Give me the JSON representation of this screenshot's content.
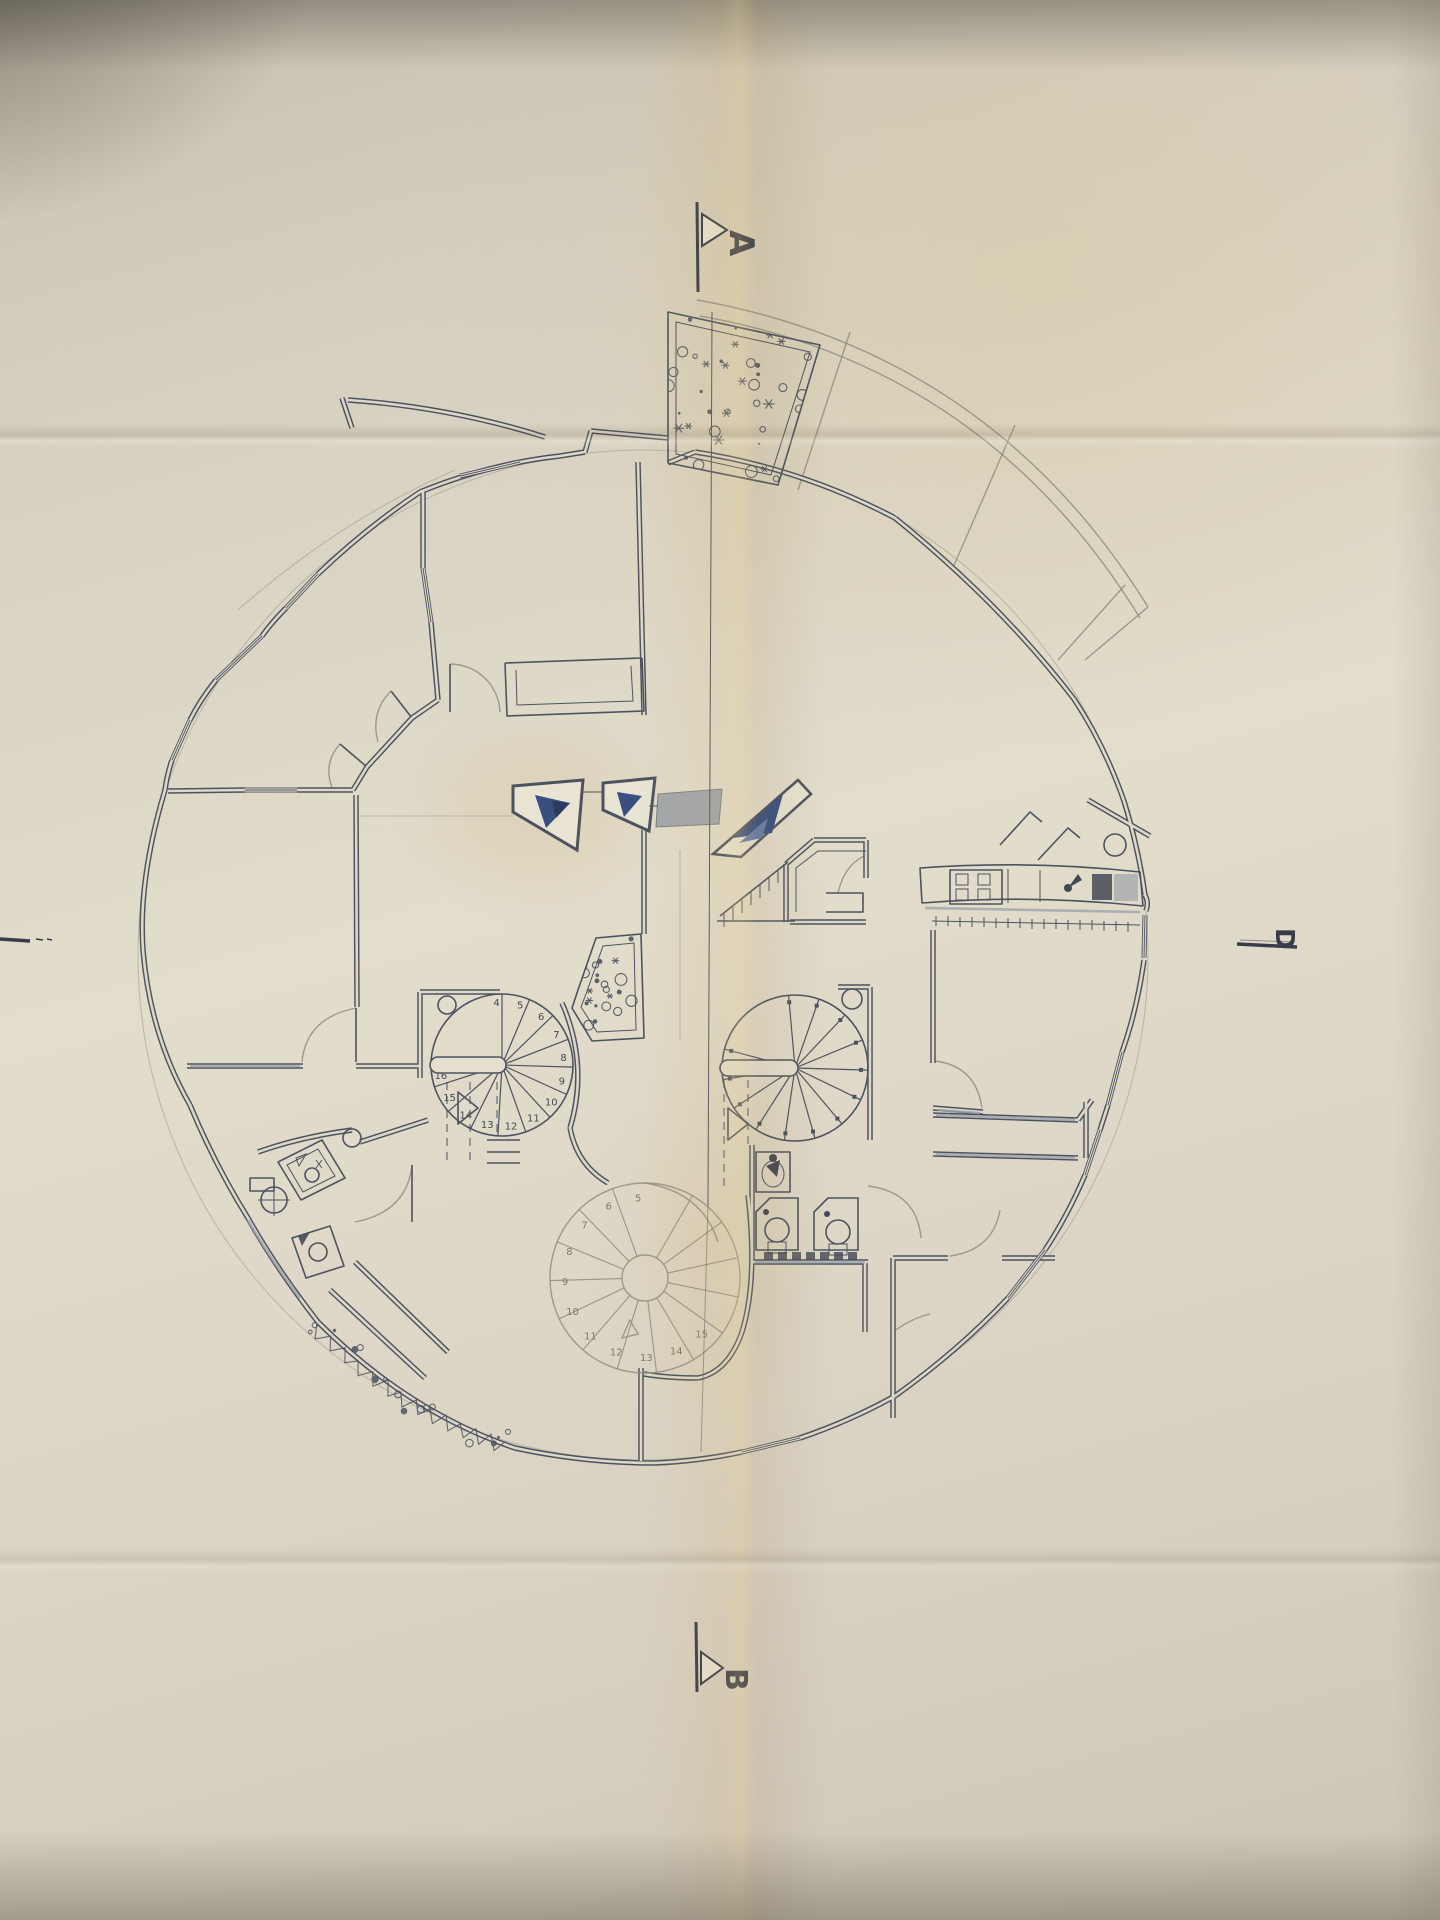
{
  "document": {
    "kind": "architectural floor plan photographed on folded paper",
    "subject": "circular house plan with spiral staircases, roof terrace and planters"
  },
  "section_markers": {
    "a_label": "A",
    "b_label": "B",
    "d_label": "D"
  },
  "stairs": {
    "left": {
      "numbers": [
        "4",
        "5",
        "6",
        "7",
        "8",
        "9",
        "10",
        "11",
        "12",
        "13",
        "14",
        "15",
        "16"
      ]
    },
    "lower": {
      "numbers": [
        "5",
        "6",
        "7",
        "8",
        "9",
        "10",
        "11",
        "12",
        "13",
        "14",
        "15"
      ]
    }
  },
  "colors": {
    "paper": "#d8d2c3",
    "paper_bright": "#e3ddcc",
    "paper_shadow": "#b7b0a1",
    "fold_tan": "#ddc37f",
    "ink": "#454c5a",
    "pencil": "#8f8a7c",
    "skylight_blue": "#31487e",
    "skylight_blue_dark": "#22335c",
    "window_gray": "#99a1ab"
  }
}
